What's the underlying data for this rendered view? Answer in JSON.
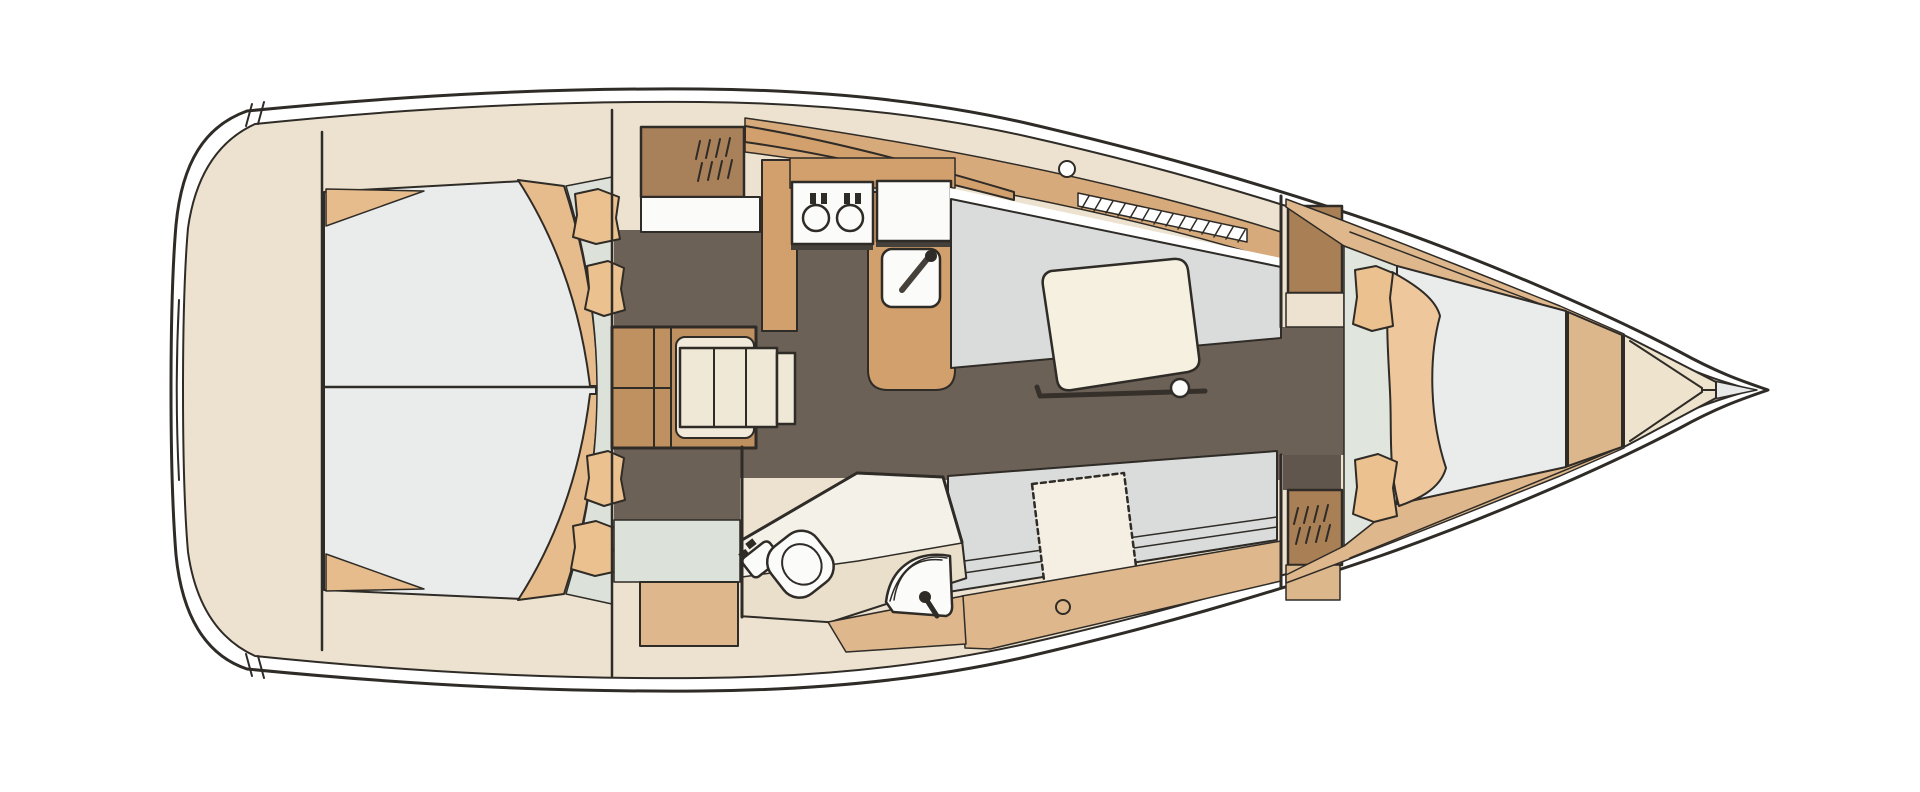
{
  "diagram": {
    "type": "yacht-interior-floorplan",
    "orientation": "bow-right",
    "areas": [
      {
        "id": "stern-deck",
        "features": [
          "transom-platform"
        ]
      },
      {
        "id": "aft-cabin",
        "features": [
          "double-berth",
          "berth-split-line",
          "curved-backrest",
          "pillows",
          "corner-shelves",
          "dressing-area"
        ]
      },
      {
        "id": "companionway",
        "features": [
          "hanging-locker",
          "shelf",
          "ladder-steps"
        ]
      },
      {
        "id": "galley",
        "features": [
          "counter",
          "two-burner-stove",
          "icebox",
          "sink-with-faucet"
        ]
      },
      {
        "id": "salon",
        "features": [
          "port-settee",
          "dining-table",
          "table-leg",
          "starboard-settee",
          "seat-cushion",
          "deck-hatch",
          "sliding-hatch-rails"
        ]
      },
      {
        "id": "head",
        "features": [
          "toilet",
          "corner-basin",
          "faucet",
          "lockers"
        ]
      },
      {
        "id": "forward-bulkhead",
        "features": [
          "wardrobe-aft",
          "wardrobe-louvered",
          "doorway"
        ]
      },
      {
        "id": "forward-cabin",
        "features": [
          "v-berth",
          "quilt",
          "pillows",
          "entry-step"
        ]
      },
      {
        "id": "bow",
        "features": [
          "anchor-locker",
          "bow-tip"
        ]
      }
    ]
  },
  "palette": {
    "white": "#ffffff",
    "cream": "#ece2cf",
    "cream_light": "#f1e9d9",
    "slats": "#efe8d7",
    "tan_band": "#d7aa7b",
    "tan_sidedeck": "#deb88c",
    "tan_counter": "#d2a06d",
    "tan_block": "#dcb78c",
    "brown_locker": "#a8815a",
    "brown_stairs": "#bf9160",
    "brown_wardrobe": "#a98056",
    "floor": "#6c6156",
    "floor_dark": "#60564d",
    "settee": "#d9dcda",
    "mattress": "#e9eceb",
    "green": "#dce2d9",
    "green_light": "#e0e5de",
    "pillow": "#ebc28f",
    "quilt": "#eec79d",
    "wedge": "#e7bc8c",
    "table": "#f6f0e1",
    "cushion": "#f4efe2",
    "head_white": "#f4f1e9",
    "head_cream": "#e9dfca",
    "appliance": "#fbfbfa",
    "bow_wedge": "#eee3cd",
    "tip": "#e8eae9",
    "shadow": "#45403a",
    "ink": "#2f2b27"
  }
}
